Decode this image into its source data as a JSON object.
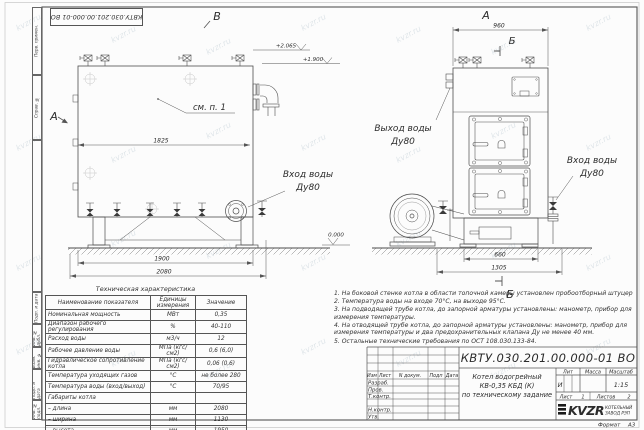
{
  "watermark": "kvzr.ru",
  "margin_labels": [
    "Перв. примен.",
    "Справ. №",
    "",
    "Подп. и дата",
    "Инв. № дубл.",
    "Взам. инв. №",
    "Подп. и дата",
    "Инв. № подл."
  ],
  "views": {
    "side": {
      "label_top": "В",
      "label_left": "А",
      "callout": "см. п. 1",
      "inlet_line1": "Вход воды",
      "inlet_line2": "Ду80",
      "dim_width": "1825",
      "dim_base": "1900",
      "dim_total": "2080",
      "elev_1": "+2.065",
      "elev_2": "+1.900",
      "elev_zero": "0.000"
    },
    "front": {
      "label_top": "А",
      "marker_top": "Б",
      "marker_bottom": "Б",
      "dim_width": "960",
      "dim_base": "660",
      "dim_total": "1305",
      "outlet_line1": "Выход воды",
      "outlet_line2": "Ду80",
      "inlet_line1": "Вход воды",
      "inlet_line2": "Ду80"
    }
  },
  "spec_table": {
    "title": "Техническая характеристика",
    "headers": [
      "Наименование показателя",
      "Единицы измерения",
      "Значение"
    ],
    "rows": [
      [
        "Номинальная мощность",
        "МВт",
        "0,35"
      ],
      [
        "Диапазон рабочего регулирования",
        "%",
        "40-110"
      ],
      [
        "Расход воды",
        "м3/ч",
        "12"
      ],
      [
        "Рабочее давление воды",
        "МПа (кгс/см2)",
        "0,6 (6,0)"
      ],
      [
        "Гидравлическое сопротивление котла",
        "МПа (кгс/см2)",
        "0,06 (0,6)"
      ],
      [
        "Температура уходящих газов",
        "°С",
        "не более 280"
      ],
      [
        "Температура воды (вход/выход)",
        "°С",
        "70/95"
      ],
      [
        "Габариты котла",
        "",
        ""
      ],
      [
        "– длина",
        "мм",
        "2080"
      ],
      [
        "– ширина",
        "мм",
        "1130"
      ],
      [
        "– высота",
        "мм",
        "1950"
      ]
    ]
  },
  "notes": [
    "1.  На боковой стенке котла в области топочной камеры установлен пробоотборный штуцер",
    "2.  Температура воды на входе 70°С, на выходе 95°С.",
    "3.  На подводящей трубе котла, до запорной арматуры установлены: манометр, прибор для измерения температуры.",
    "4.  На отводящей трубе котла, до запорной арматуры установлены: манометр, прибор для измерения температуры и два предохранительных клапана Ду не менее 40 мм.",
    "5.  Остальные технические требования по ОСТ 108.030.133-84."
  ],
  "title_block": {
    "designation": "КВТУ.030.201.00.000-01 ВО",
    "doc_name_line1": "Котел водогрейный",
    "doc_name_line2": "КВ-0,35 КБД (К)",
    "doc_name_line3": "по техническому задание",
    "col_izm": "Изм",
    "col_list": "Лист",
    "col_ndoc": "N докум.",
    "col_podp": "Подп",
    "col_data": "Дата",
    "row_razrab": "Разраб.",
    "row_prov": "Пров.",
    "row_tkontr": "Т.контр.",
    "row_nkontr": "Н.контр.",
    "row_utv": "Утв.",
    "lit_header": "Лит",
    "massa_header": "Масса",
    "masshtab_header": "Масштаб",
    "lit_value": "И",
    "masshtab_value": "1:15",
    "list_label": "Лист",
    "list_value": "1",
    "listov_label": "Листов",
    "listov_value": "2",
    "logo_text": "KVZR",
    "logo_sub1": "КОТЕЛЬНЫЙ",
    "logo_sub2": "ЗАВОД РЭП",
    "format_label": "Формат",
    "format_value": "А3"
  }
}
